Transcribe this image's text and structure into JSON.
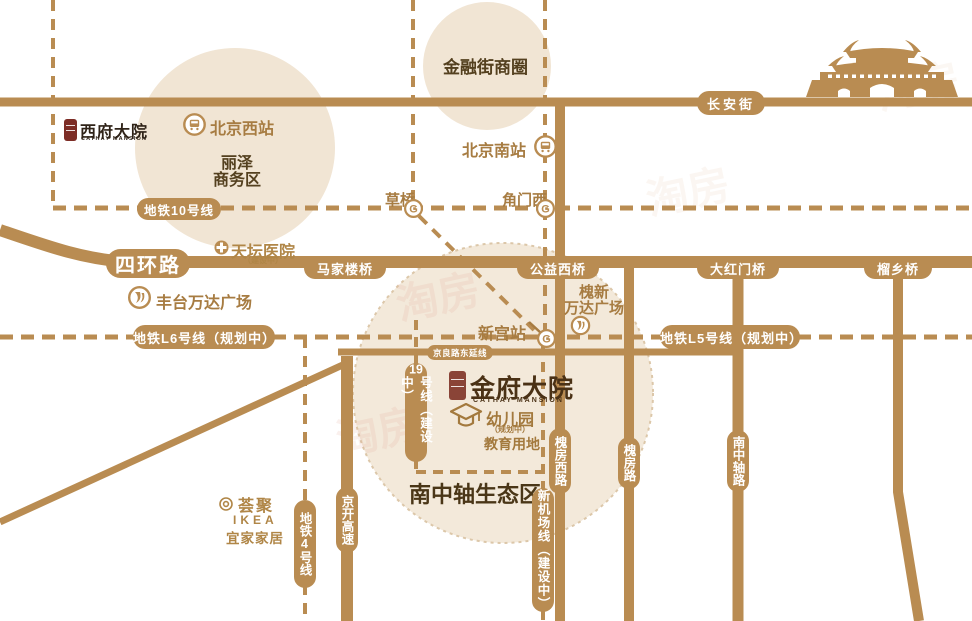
{
  "colors": {
    "road_tan": "#b98c52",
    "zone_fill": "#f1e5d4",
    "zone_fill_south": "#f3e9da",
    "zone_stitch": "#dcc7a9",
    "dark_text": "#54401f",
    "station_text": "#a77c42",
    "poi_tan_text": "#b08647",
    "logo_dark": "#4a3115",
    "seal_red": "#8a4437",
    "watermark_pink": "#e2a08c",
    "label_text_on_capsule": "#ffffff"
  },
  "logos": {
    "xifu": {
      "title": "西府大院",
      "subtitle": "CATHAY MANSION"
    },
    "jinfu": {
      "title": "金府大院",
      "subtitle": "CATHAY MANSION"
    }
  },
  "areas": {
    "lize_line1": "丽泽",
    "lize_line2": "商务区",
    "financial_street": "金融街商圈",
    "eco_zone": "南中轴生态区"
  },
  "roads": {
    "changan": "长安街",
    "fourth_ring": "四环路",
    "jingliang": "京良路东延线",
    "jingkai": "京开高速",
    "huaifang_west": "槐房西路",
    "huaifang": "槐房路",
    "nanzhongzhou": "南中轴路"
  },
  "bridges": {
    "majialou": "马家楼桥",
    "gongyi_west": "公益西桥",
    "dahongmen": "大红门桥",
    "liuxiang": "榴乡桥"
  },
  "metro_lines": {
    "line10": "地铁10号线",
    "line_l6": "地铁L6号线（规划中）",
    "line_l5": "地铁L5号线（规划中）",
    "line19_num": "19",
    "line19_text": "号线（建设中）",
    "line4": "地铁4号线",
    "new_airport": "新机场线（建设中）"
  },
  "stations": {
    "beijing_west": "北京西站",
    "beijing_south": "北京南站",
    "caoqiao": "草桥",
    "jiaomen_west": "角门西",
    "xingong": "新宫站"
  },
  "pois": {
    "tiantan_hospital": "天坛医院",
    "tiantan_sub": "（建设中）",
    "fengtai_wanda": "丰台万达广场",
    "huaixin_wanda_line1": "槐新",
    "huaixin_wanda_line2": "万达广场",
    "huiju": "荟聚",
    "ikea_en": "IKEA",
    "ikea_cn": "宜家家居",
    "kindergarten": "幼儿园",
    "kindergarten_sub": "（规划中）",
    "education_land": "教育用地"
  },
  "watermark": "淘房"
}
